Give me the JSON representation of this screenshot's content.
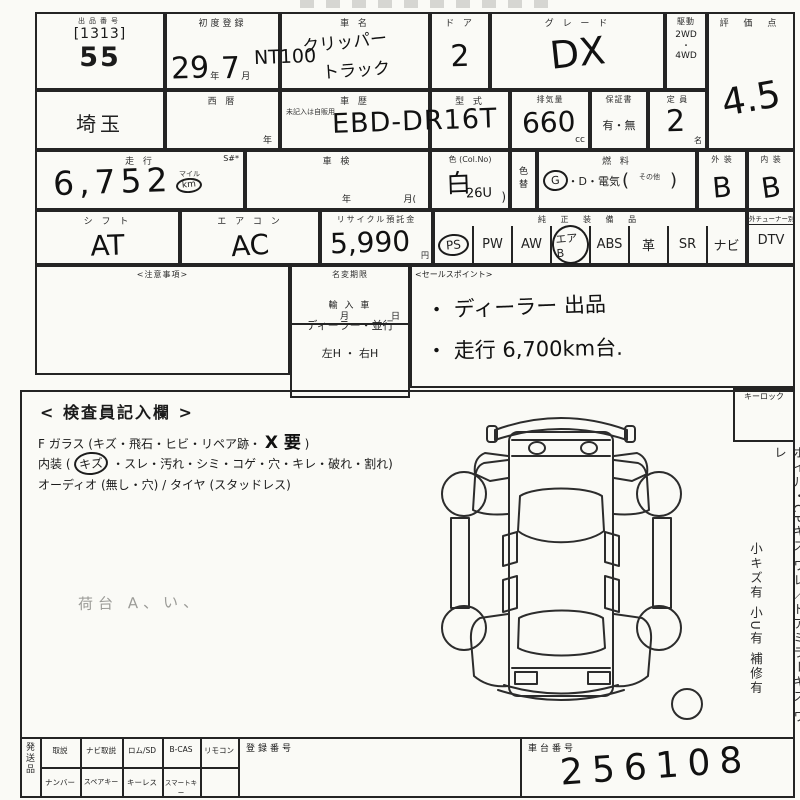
{
  "r1": {
    "lot": {
      "header": "出品番号",
      "code": "[1313]",
      "number": "55"
    },
    "reg": {
      "label": "初度登録",
      "year": "29",
      "y_unit": "年",
      "month": "7",
      "m_unit": "月"
    },
    "name": {
      "label": "車  名",
      "prefix": "NT100",
      "line1": "クリッパー",
      "line2": "トラック"
    },
    "doors": {
      "label": "ド ア",
      "value": "2"
    },
    "grade": {
      "label": "グ レ ー ド",
      "value": "DX"
    },
    "drive": {
      "label": "駆動",
      "opt1": "2WD",
      "dot": "・",
      "opt2": "4WD"
    },
    "score": {
      "label": "評 価 点",
      "value": "4.5"
    }
  },
  "r2": {
    "pref": {
      "value": "埼玉"
    },
    "seireki": {
      "label": "西  暦",
      "unit": "年"
    },
    "shareki": {
      "label": "車  歴",
      "note": "未記入は自販用"
    },
    "model": {
      "label": "型  式",
      "value": "EBD-DR16T"
    },
    "disp": {
      "label": "排気量",
      "value": "660",
      "unit": "cc"
    },
    "warranty": {
      "label": "保証書",
      "value": "有・無"
    },
    "capacity": {
      "label": "定 員",
      "value": "2",
      "unit": "名"
    }
  },
  "r3": {
    "mileage": {
      "label": "走  行",
      "s": "S#*",
      "value": "6,752",
      "unit_top": "マイル",
      "unit_bottom": "km"
    },
    "shaken": {
      "label": "車  検",
      "year": "年",
      "month": "月("
    },
    "color": {
      "label": "色 (Col.No)",
      "value": "白",
      "code": "26U",
      "paren": ")"
    },
    "colorchg": {
      "l1": "色",
      "l2": "替"
    },
    "fuel": {
      "label": "燃  料",
      "g": "G",
      "mid": "・D・電気",
      "open": "(",
      "sonota": "その他",
      "close": ")"
    },
    "ext": {
      "label": "外 装",
      "value": "B"
    },
    "int": {
      "label": "内 装",
      "value": "B"
    }
  },
  "r4": {
    "shift": {
      "label": "シ フ ト",
      "value": "AT"
    },
    "aircon": {
      "label": "エ ア コ ン",
      "value": "AC"
    },
    "recycle": {
      "label": "リサイクル預託金",
      "value": "5,990",
      "unit": "円"
    },
    "equip": {
      "label": "純 正 装 備 品",
      "items": [
        {
          "label": "PS",
          "circled": true
        },
        {
          "label": "PW",
          "circled": false
        },
        {
          "label": "AW",
          "circled": false
        },
        {
          "label": "エアB",
          "circled": true
        },
        {
          "label": "ABS",
          "circled": false
        },
        {
          "label": "革",
          "circled": false
        },
        {
          "label": "SR",
          "circled": false
        },
        {
          "label": "ナビ",
          "circled": false
        }
      ]
    },
    "dtv": {
      "note": "外チューナー別",
      "label": "DTV"
    }
  },
  "mid": {
    "caution_label": "<注意事項>",
    "namechange": {
      "label": "名変期限",
      "month": "月",
      "day": "日",
      "import_label": "輸 入 車",
      "import_opts": "ディーラー・並行",
      "handle_opts": "左H ・ 右H"
    },
    "sales": {
      "label": "<セールスポイント>",
      "point1": "・ ディーラー 出品",
      "point2": "・ 走行 6,700km台."
    }
  },
  "insp": {
    "title": "< 検査員記入欄 >",
    "l1_pre": "F ガラス (キズ・飛石・ヒビ・リペア跡・",
    "l1_hw": "X 要",
    "l1_close": ")",
    "l2_pre": "内装 (",
    "l2_circled": "キズ",
    "l2_post": "・スレ・汚れ・シミ・コゲ・穴・キレ・破れ・割れ)",
    "l3": "オーディオ (無し・穴) / タイヤ (スタッドレス)",
    "hand_note": "荷台 A、い、",
    "keylock": "キーロック",
    "side1": "ホイル・CPキズ ワレ／ドアミラーキズ ワレ",
    "side2": "小キズ有 小U有 補修有"
  },
  "bottom": {
    "group_label": "発送品",
    "r1c": [
      "取説",
      "ナビ取説",
      "ロム/SD",
      "B-CAS",
      "リモコン"
    ],
    "r2c": [
      "ナンバー",
      "スペアキー",
      "キーレス",
      "スマートキー"
    ],
    "regno_label": "登録番号",
    "chassis_label": "車台番号",
    "chassis_value": "256108"
  }
}
